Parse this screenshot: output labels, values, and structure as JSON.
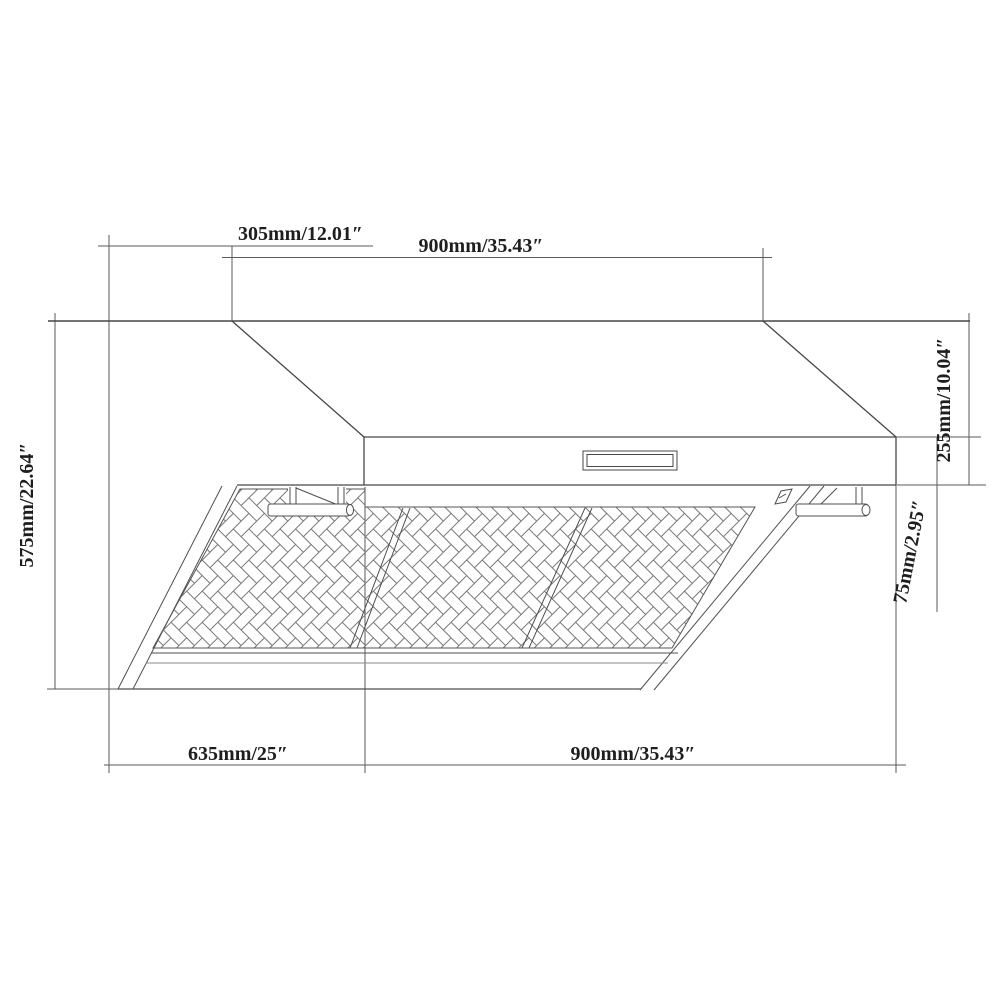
{
  "drawing": {
    "background": "#ffffff",
    "line_color": "#4a4a4a",
    "light_line_color": "#8a8a8a",
    "text_color": "#1e1e1e",
    "dimensions": {
      "top_offset": "305mm/12.01″",
      "top_width": "900mm/35.43″",
      "left_height": "575mm/22.64″",
      "right_upper_height": "255mm/10.04″",
      "right_lower_height": "75mm/2.95″",
      "bottom_depth": "635mm/25″",
      "bottom_width": "900mm/35.43″"
    }
  }
}
